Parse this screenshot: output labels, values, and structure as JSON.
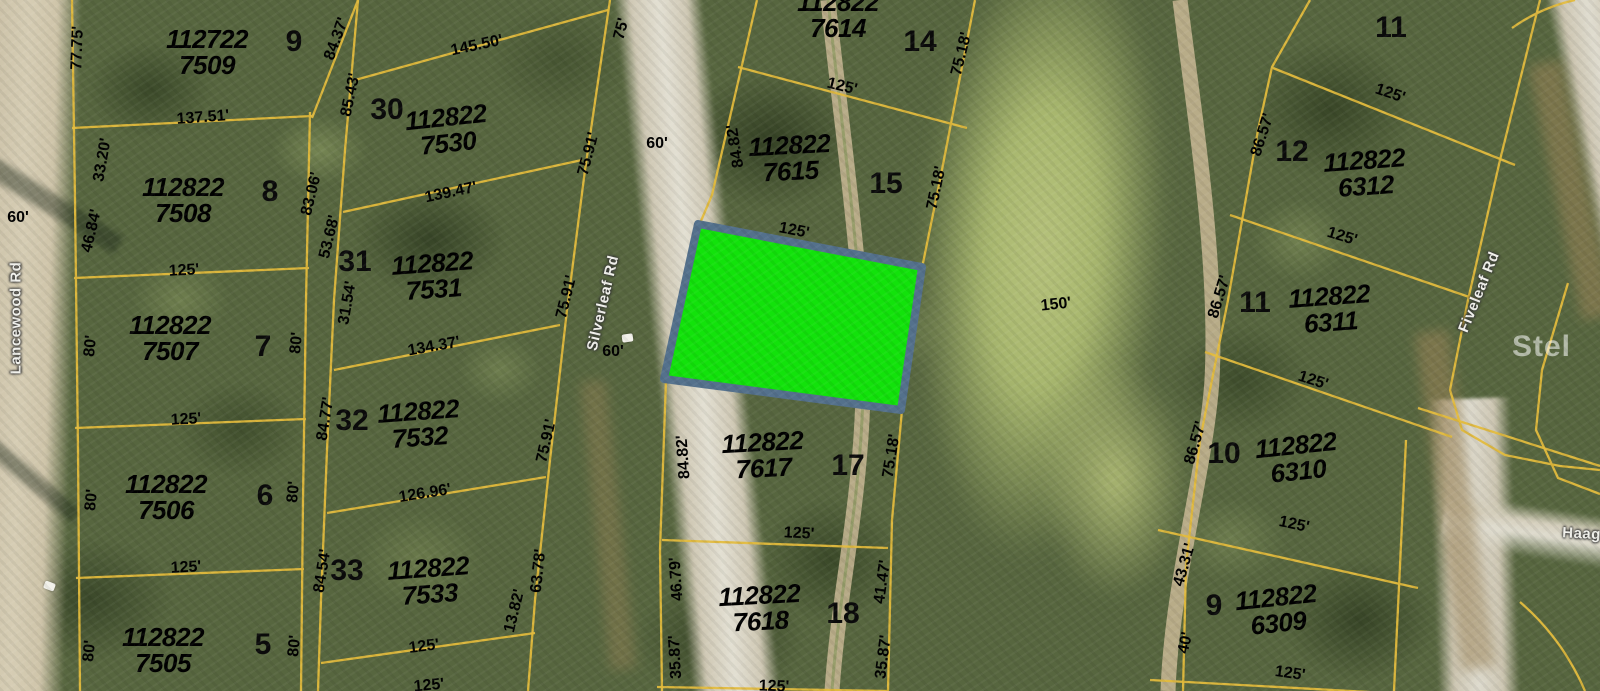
{
  "highlight": {
    "fill": "#12e20b",
    "border": "#54718c"
  },
  "boundary_color": "#e3bb3c",
  "watermark": "Stel",
  "roads": {
    "lancewood": "Lancewood Rd",
    "silverleaf": "Silverleaf Rd",
    "fiveleaf": "Fiveleaf Rd",
    "haagen_partial": "Haage"
  },
  "parcels": {
    "p7509": {
      "id1": "112722",
      "id2": "7509",
      "lot": "9"
    },
    "p7508": {
      "id1": "112822",
      "id2": "7508",
      "lot": "8"
    },
    "p7507": {
      "id1": "112822",
      "id2": "7507",
      "lot": "7"
    },
    "p7506": {
      "id1": "112822",
      "id2": "7506",
      "lot": "6"
    },
    "p7505": {
      "id1": "112822",
      "id2": "7505",
      "lot": "5"
    },
    "p7530": {
      "id1": "112822",
      "id2": "7530",
      "lot": "30"
    },
    "p7531": {
      "id1": "112822",
      "id2": "7531",
      "lot": "31"
    },
    "p7532": {
      "id1": "112822",
      "id2": "7532",
      "lot": "32"
    },
    "p7533": {
      "id1": "112822",
      "id2": "7533",
      "lot": "33"
    },
    "p7614": {
      "id1": "112822",
      "id2": "7614",
      "lot": "14"
    },
    "p7615": {
      "id1": "112822",
      "id2": "7615",
      "lot": "15"
    },
    "p7617": {
      "id1": "112822",
      "id2": "7617",
      "lot": "17"
    },
    "p7618": {
      "id1": "112822",
      "id2": "7618",
      "lot": "18"
    },
    "p6312": {
      "id1": "112822",
      "id2": "6312",
      "lot": "12"
    },
    "p6311": {
      "id1": "112822",
      "id2": "6311",
      "lot": "11"
    },
    "p6310": {
      "id1": "112822",
      "id2": "6310",
      "lot": "10"
    },
    "p6309": {
      "id1": "112822",
      "id2": "6309",
      "lot": "9"
    },
    "lot11_top": {
      "lot": "11"
    }
  },
  "dims": [
    "77.75'",
    "84.37'",
    "85.43'",
    "137.51'",
    "33.20'",
    "46.84'",
    "83.06'",
    "53.68'",
    "60'",
    "125'",
    "80'",
    "80'",
    "125'",
    "80'",
    "80'",
    "125'",
    "80'",
    "80'",
    "125'",
    "145.50'",
    "75'",
    "139.47'",
    "75.91'",
    "60'",
    "31.54'",
    "134.37'",
    "75.91'",
    "60'",
    "84.77'",
    "126.96'",
    "75.91'",
    "84.54'",
    "63.78'",
    "13.82'",
    "125'",
    "125'",
    "75.18'",
    "84.82'",
    "125'",
    "75.18'",
    "150'",
    "84.82'",
    "75.18'",
    "125'",
    "46.79'",
    "41.47'",
    "35.87'",
    "35.87'",
    "125'",
    "86.57'",
    "125'",
    "86.57'",
    "125'",
    "86.57'",
    "125'",
    "43.31'",
    "125'",
    "40'",
    "125'"
  ]
}
